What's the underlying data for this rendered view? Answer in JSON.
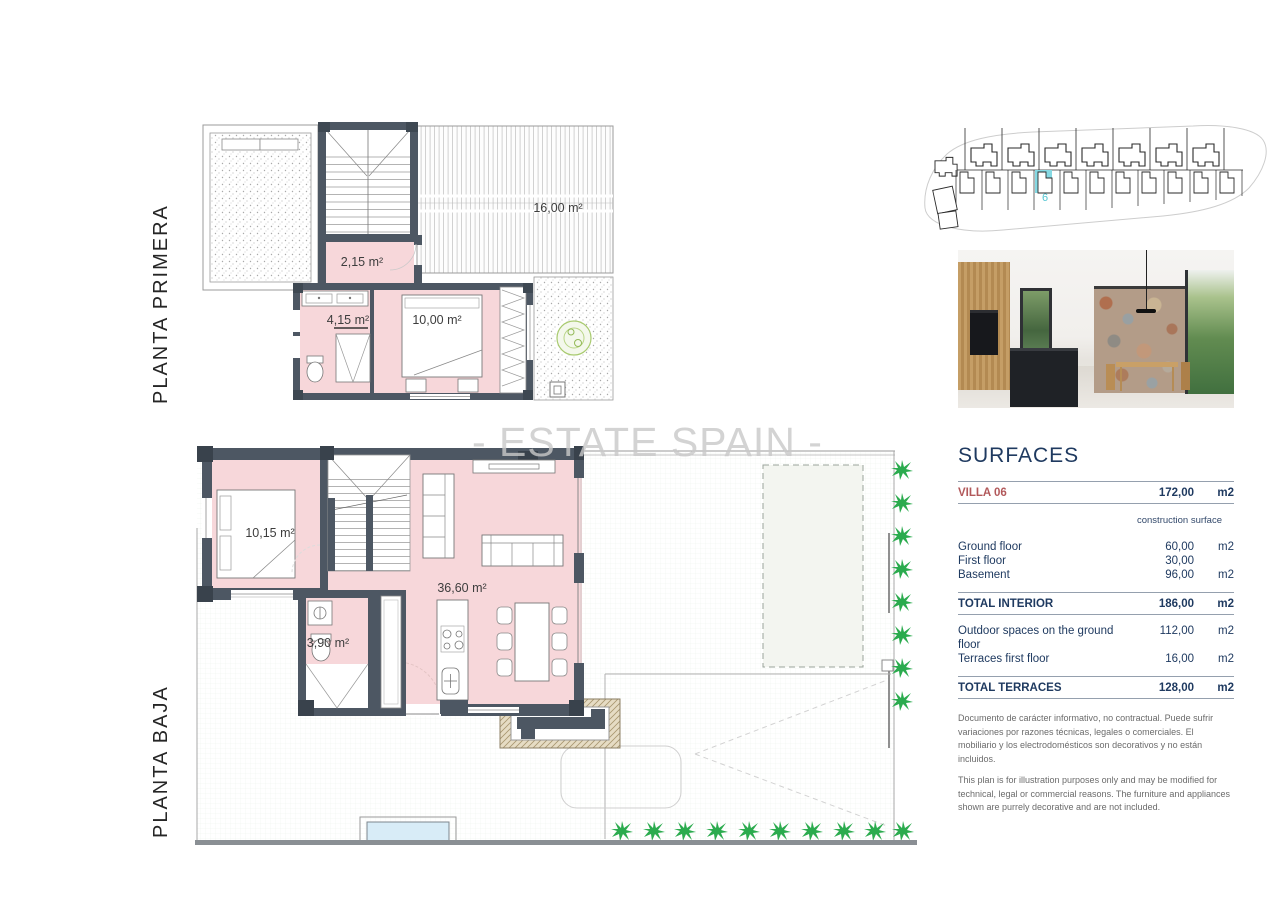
{
  "watermark": {
    "text": "- ESTATE SPAIN -"
  },
  "floor_plans": {
    "first_floor": {
      "title": "PLANTA PRIMERA",
      "room_labels": {
        "stair_hall": "2,15 m²",
        "bathroom": "4,15 m²",
        "bedroom": "10,00 m²",
        "terrace": "16,00 m²"
      }
    },
    "ground_floor": {
      "title": "PLANTA BAJA",
      "room_labels": {
        "bedroom": "10,15 m²",
        "bathroom": "3,90 m²",
        "living_kitchen": "36,60 m²"
      }
    }
  },
  "site_plan": {
    "highlighted_villa_number": "6",
    "highlight_color": "#86d9e3"
  },
  "surfaces_panel": {
    "title": "SURFACES",
    "villa_row": {
      "label": "VILLA 06",
      "value": "172,00",
      "unit": "m2"
    },
    "column_header": "construction surface",
    "rows": [
      {
        "label": "Ground floor",
        "value": "60,00",
        "unit": "m2"
      },
      {
        "label": "First floor",
        "value": "30,00",
        "unit": ""
      },
      {
        "label": "Basement",
        "value": "96,00",
        "unit": "m2"
      }
    ],
    "total_interior": {
      "label": "TOTAL INTERIOR",
      "value": "186,00",
      "unit": "m2"
    },
    "outdoor_rows": [
      {
        "label": "Outdoor spaces on the ground floor",
        "value": "112,00",
        "unit": "m2"
      },
      {
        "label": "Terraces first floor",
        "value": "16,00",
        "unit": "m2"
      }
    ],
    "total_terraces": {
      "label": "TOTAL TERRACES",
      "value": "128,00",
      "unit": "m2"
    },
    "disclaimer_es": "Documento de carácter informativo, no contractual. Puede sufrir variaciones por razones técnicas, legales o comerciales. El mobiliario y los electrodomésticos son decorativos y no están incluidos.",
    "disclaimer_en": "This plan is for illustration purposes only and may be modified for technical, legal or commercial reasons. The furniture and appliances shown are purrely decorative and are not included."
  },
  "colors": {
    "room_fill": "#f7d7da",
    "wall": "#4d5763",
    "tree_green": "#2bab4e",
    "pool_blue": "#d8ecf7",
    "navy_text": "#1f3a60",
    "villa_red": "#b2595b",
    "watermark_gray": "#c9c9c9"
  }
}
